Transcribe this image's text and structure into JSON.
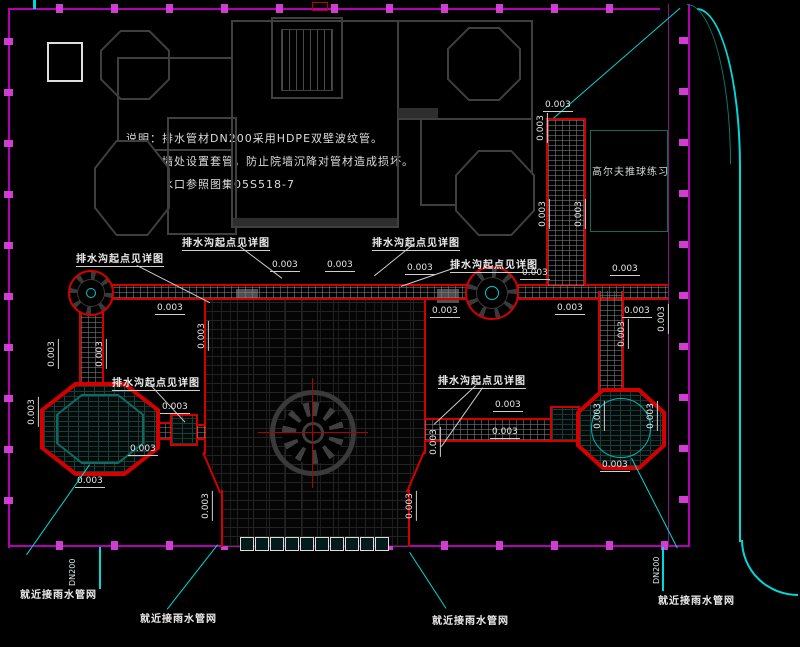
{
  "notes": {
    "line1": "说明：排水管材DN200采用HDPE双壁波纹管。",
    "line2": "穿墙处设置套管，防止院墙沉降对管材造成损坏。",
    "line3": "雨水口参照图集05S518-7"
  },
  "labels": {
    "slope": "0.003",
    "detail": "排水沟起点见详图",
    "connect": "就近接雨水管网",
    "pipe_dn": "DN200",
    "golf": "高尔夫推球练习"
  },
  "colors": {
    "background": "#000000",
    "drain_red": "#d40000",
    "fence_magenta": "#b400b4",
    "road_cyan": "#00d9d9",
    "pavilion_teal": "#0d6b62",
    "text_white": "#e6e6e6"
  }
}
